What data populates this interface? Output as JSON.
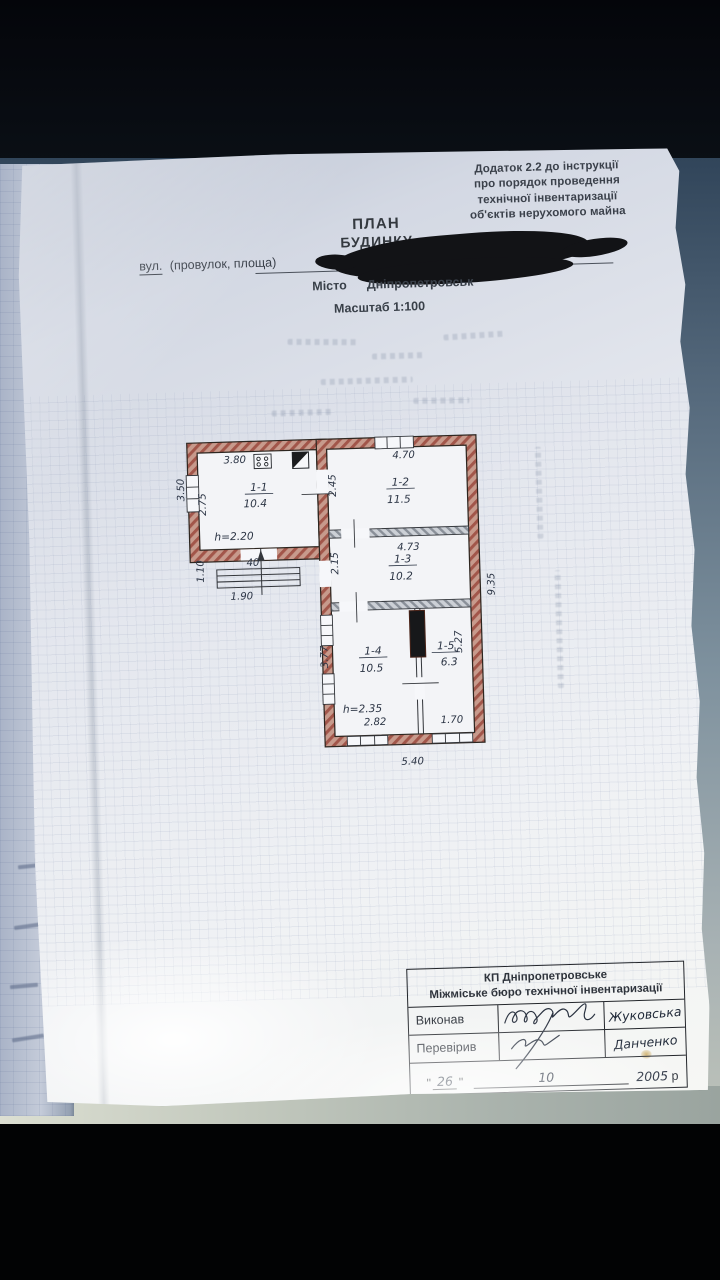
{
  "appendix": {
    "lines": [
      "Додаток 2.2 до інструкції",
      "про порядок проведення",
      "технічної інвентаризації",
      "об'єктів нерухомого майна"
    ]
  },
  "header": {
    "title": "ПЛАН",
    "subtitle": "БУДИНКУ",
    "street_label_underlined": "вул.",
    "street_label_rest": "(провулок, площа)",
    "city_label": "Місто",
    "city_value": "Дніпропетровськ",
    "scale": "Масштаб 1:100"
  },
  "plan": {
    "rooms": [
      {
        "number": "1-1",
        "area": "10.4"
      },
      {
        "number": "1-2",
        "area": "11.5"
      },
      {
        "number": "1-3",
        "area": "10.2"
      },
      {
        "number": "1-4",
        "area": "10.5"
      },
      {
        "number": "1-5",
        "area": "6.3"
      }
    ],
    "dims": {
      "wing_top": "3.80",
      "wing_left_outer": "3.50",
      "wing_left_inner": "2.75",
      "wing_ceiling": "h=2.20",
      "porch_depth": "1.10",
      "porch_step": "40",
      "porch_width": "1.90",
      "room2_top": "4.70",
      "room2_left": "2.45",
      "room3_top": "4.73",
      "room3_left": "2.15",
      "right_total": "9.35",
      "right_lower": "5.27",
      "lower_left": "3.77",
      "lower_ceiling": "h=2.35",
      "room4_bottom": "2.82",
      "room5_bottom": "1.70",
      "bottom_total": "5.40"
    }
  },
  "stamp": {
    "org_line1": "КП Дніпропетровське",
    "org_line2": "Міжміське бюро технічної інвентаризації",
    "executed_label": "Виконав",
    "checked_label": "Перевірив",
    "executed_name": "Жуковська",
    "checked_name": "Данченко",
    "date_quote": "\"",
    "date_day": "26",
    "date_month": "10",
    "date_year": "2005",
    "date_year_suffix": "р"
  },
  "colors": {
    "wall_brick": "#a2564a",
    "wall_gray": "#8a9099",
    "ink": "#2c3545",
    "paper": "#e9ecf2",
    "marker": "#121316"
  }
}
